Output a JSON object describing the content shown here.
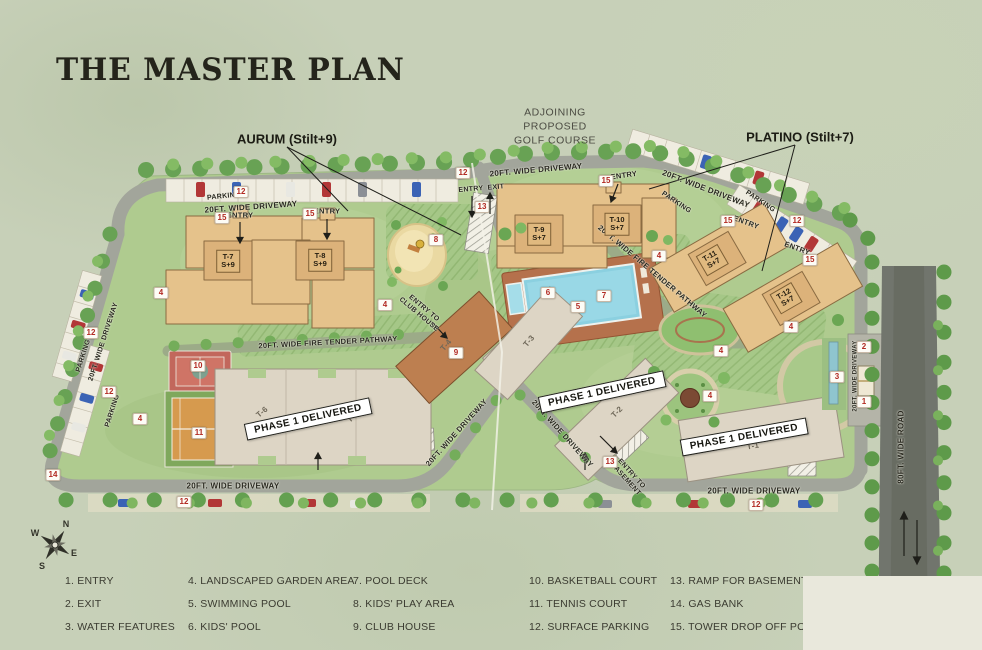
{
  "title": "THE MASTER PLAN",
  "callouts": {
    "aurum": "AURUM (Stilt+9)",
    "platino": "PLATINO (Stilt+7)",
    "golf": "ADJOINING\nPROPOSED\nGOLF COURSE"
  },
  "compass": {
    "n": "N",
    "e": "E",
    "s": "S",
    "w": "W"
  },
  "colors": {
    "marker_red": "#b22a23",
    "building_tan": "#e5c28b",
    "phase1_grey": "#ddd5c5",
    "clubhouse_brown": "#bd7f50",
    "pool_blue": "#8bd0e0",
    "lawn_green": "#afcb8f",
    "road_grey": "#a2a59b"
  },
  "map": {
    "road_labels": [
      {
        "t": "20FT. WIDE DRIVEWAY",
        "x": 251,
        "y": 207,
        "r": -4
      },
      {
        "t": "PARKING",
        "x": 224,
        "y": 197,
        "r": -6,
        "fs": 7
      },
      {
        "t": "20FT. WIDE DRIVEWAY",
        "x": 536,
        "y": 170,
        "r": -5
      },
      {
        "t": "20FT. WIDE DRIVEWAY",
        "x": 706,
        "y": 189,
        "r": 21
      },
      {
        "t": "PARKING",
        "x": 676,
        "y": 203,
        "r": 34,
        "fs": 7
      },
      {
        "t": "PARKING",
        "x": 760,
        "y": 202,
        "r": 34,
        "fs": 7
      },
      {
        "t": "ENTRY",
        "x": 471,
        "y": 190,
        "r": -5,
        "fs": 7
      },
      {
        "t": "EXIT",
        "x": 496,
        "y": 188,
        "r": -5,
        "fs": 7
      },
      {
        "t": "PARKING",
        "x": 84,
        "y": 356,
        "r": -72,
        "fs": 7
      },
      {
        "t": "PARKING",
        "x": 113,
        "y": 411,
        "r": -72,
        "fs": 7
      },
      {
        "t": "20FT. WIDE DRIVEWAY",
        "x": 104,
        "y": 342,
        "r": -72,
        "fs": 7
      },
      {
        "t": "20FT. WIDE FIRE TENDER PATHWAY",
        "x": 328,
        "y": 343,
        "r": -3,
        "fs": 7.5
      },
      {
        "t": "20FT. WIDE FIRE TENDER PATHWAY",
        "x": 652,
        "y": 272,
        "r": 40,
        "fs": 7.5
      },
      {
        "t": "ENTRY TO\nCLUB HOUSE",
        "x": 421,
        "y": 312,
        "r": 40,
        "fs": 7
      },
      {
        "t": "20FT. WIDE DRIVEWAY",
        "x": 457,
        "y": 433,
        "r": -48,
        "fs": 7.5
      },
      {
        "t": "20FT. WIDE DRIVEWAY",
        "x": 562,
        "y": 434,
        "r": 48,
        "fs": 7.5
      },
      {
        "t": "ENTRY TO\nBASEMENT",
        "x": 628,
        "y": 477,
        "r": 48,
        "fs": 7
      },
      {
        "t": "20FT. WIDE DRIVEWAY",
        "x": 233,
        "y": 486,
        "r": 0
      },
      {
        "t": "20FT. WIDE DRIVEWAY",
        "x": 754,
        "y": 491,
        "r": 0
      },
      {
        "t": "20FT. WIDE DRIVEWAY",
        "x": 856,
        "y": 376,
        "r": -90,
        "fs": 6
      },
      {
        "t": "80FT. WIDE ROAD",
        "x": 901,
        "y": 447,
        "r": -90
      },
      {
        "t": "ENTRY",
        "x": 240,
        "y": 216,
        "r": 0,
        "fs": 7.5
      },
      {
        "t": "ENTRY",
        "x": 327,
        "y": 212,
        "r": 0,
        "fs": 7.5
      },
      {
        "t": "ENTRY",
        "x": 624,
        "y": 176,
        "r": -8,
        "fs": 7.5
      },
      {
        "t": "ENTRY",
        "x": 746,
        "y": 223,
        "r": 20,
        "fs": 7.5
      },
      {
        "t": "ENTRY",
        "x": 797,
        "y": 249,
        "r": 20,
        "fs": 7.5
      }
    ],
    "towers_boxed": [
      {
        "t": "T-7\nS+9",
        "x": 228,
        "y": 261,
        "r": 0
      },
      {
        "t": "T-8\nS+9",
        "x": 320,
        "y": 260,
        "r": 0
      },
      {
        "t": "T-9\nS+7",
        "x": 539,
        "y": 234,
        "r": 0
      },
      {
        "t": "T-10\nS+7",
        "x": 617,
        "y": 224,
        "r": 0
      },
      {
        "t": "T-11\nS+7",
        "x": 712,
        "y": 260,
        "r": -30
      },
      {
        "t": "T-12\nS+7",
        "x": 786,
        "y": 298,
        "r": -30
      }
    ],
    "towers_plain": [
      {
        "t": "T-6",
        "x": 262,
        "y": 412,
        "r": -40
      },
      {
        "t": "T-5",
        "x": 353,
        "y": 417,
        "r": -40
      },
      {
        "t": "T-4",
        "x": 446,
        "y": 345,
        "r": -50
      },
      {
        "t": "T-3",
        "x": 529,
        "y": 341,
        "r": -50
      },
      {
        "t": "T-2",
        "x": 617,
        "y": 412,
        "r": -45
      },
      {
        "t": "T-1",
        "x": 753,
        "y": 446,
        "r": -10
      }
    ],
    "markers": [
      {
        "t": "12",
        "x": 241,
        "y": 192
      },
      {
        "t": "12",
        "x": 463,
        "y": 173
      },
      {
        "t": "12",
        "x": 797,
        "y": 221
      },
      {
        "t": "12",
        "x": 91,
        "y": 333
      },
      {
        "t": "12",
        "x": 109,
        "y": 392
      },
      {
        "t": "12",
        "x": 184,
        "y": 502
      },
      {
        "t": "12",
        "x": 756,
        "y": 505
      },
      {
        "t": "15",
        "x": 222,
        "y": 218
      },
      {
        "t": "15",
        "x": 310,
        "y": 214
      },
      {
        "t": "15",
        "x": 606,
        "y": 181
      },
      {
        "t": "15",
        "x": 728,
        "y": 221
      },
      {
        "t": "15",
        "x": 810,
        "y": 260
      },
      {
        "t": "13",
        "x": 482,
        "y": 207
      },
      {
        "t": "13",
        "x": 610,
        "y": 462
      },
      {
        "t": "14",
        "x": 53,
        "y": 475
      },
      {
        "t": "4",
        "x": 161,
        "y": 293
      },
      {
        "t": "4",
        "x": 385,
        "y": 305
      },
      {
        "t": "4",
        "x": 140,
        "y": 419
      },
      {
        "t": "4",
        "x": 659,
        "y": 256
      },
      {
        "t": "4",
        "x": 791,
        "y": 327
      },
      {
        "t": "4",
        "x": 721,
        "y": 351
      },
      {
        "t": "4",
        "x": 710,
        "y": 396
      },
      {
        "t": "8",
        "x": 436,
        "y": 240
      },
      {
        "t": "5",
        "x": 578,
        "y": 307
      },
      {
        "t": "6",
        "x": 548,
        "y": 293
      },
      {
        "t": "7",
        "x": 604,
        "y": 296
      },
      {
        "t": "10",
        "x": 198,
        "y": 366
      },
      {
        "t": "11",
        "x": 199,
        "y": 433
      },
      {
        "t": "9",
        "x": 456,
        "y": 353
      },
      {
        "t": "1",
        "x": 864,
        "y": 402
      },
      {
        "t": "2",
        "x": 864,
        "y": 347
      },
      {
        "t": "3",
        "x": 837,
        "y": 377
      }
    ],
    "phase_boxes": [
      {
        "t": "PHASE 1 DELIVERED",
        "x": 308,
        "y": 419,
        "r": -12
      },
      {
        "t": "PHASE 1 DELIVERED",
        "x": 602,
        "y": 392,
        "r": -12
      },
      {
        "t": "PHASE 1 DELIVERED",
        "x": 744,
        "y": 437,
        "r": -10
      }
    ]
  },
  "legend": [
    {
      "t": "1. ENTRY",
      "x": 65,
      "y": 581
    },
    {
      "t": "2. EXIT",
      "x": 65,
      "y": 604
    },
    {
      "t": "3. WATER FEATURES",
      "x": 65,
      "y": 627
    },
    {
      "t": "4. LANDSCAPED GARDEN AREA",
      "x": 188,
      "y": 581
    },
    {
      "t": "5. SWIMMING POOL",
      "x": 188,
      "y": 604
    },
    {
      "t": "6. KIDS' POOL",
      "x": 188,
      "y": 627
    },
    {
      "t": "7. POOL DECK",
      "x": 353,
      "y": 581
    },
    {
      "t": "8. KIDS' PLAY AREA",
      "x": 353,
      "y": 604
    },
    {
      "t": "9. CLUB HOUSE",
      "x": 353,
      "y": 627
    },
    {
      "t": "10. BASKETBALL COURT",
      "x": 529,
      "y": 581
    },
    {
      "t": "11. TENNIS COURT",
      "x": 529,
      "y": 604
    },
    {
      "t": "12. SURFACE PARKING",
      "x": 529,
      "y": 627
    },
    {
      "t": "13. RAMP FOR BASEMENT",
      "x": 670,
      "y": 581
    },
    {
      "t": "14. GAS BANK",
      "x": 670,
      "y": 604
    },
    {
      "t": "15. TOWER DROP OFF POINT",
      "x": 670,
      "y": 627
    }
  ]
}
